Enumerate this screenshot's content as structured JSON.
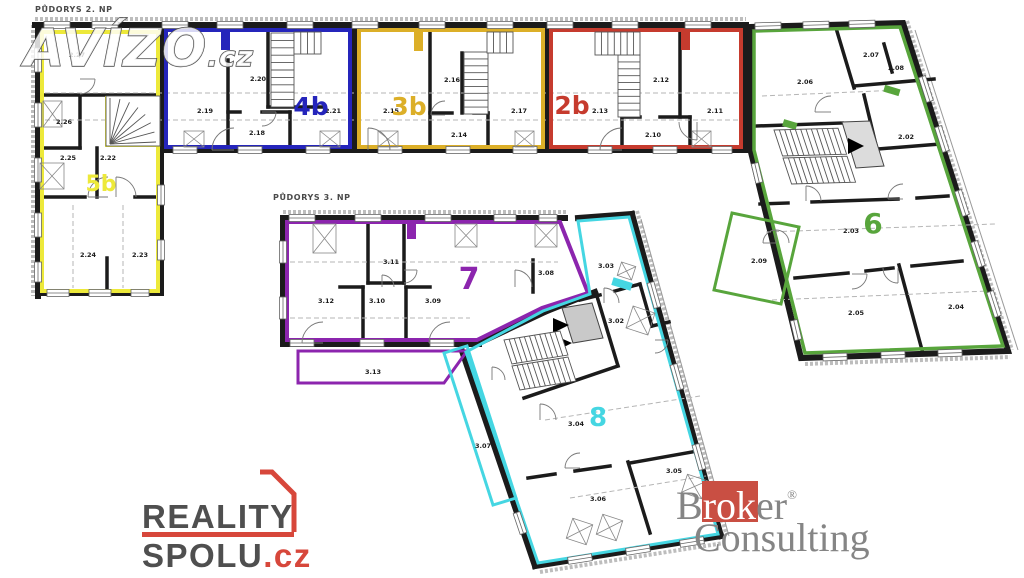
{
  "watermark": {
    "name": "AVÍZO",
    "tld": ".cz"
  },
  "plans": [
    {
      "title": "PŮDORYS 2. NP"
    },
    {
      "title": "PŮDORYS 3. NP"
    }
  ],
  "units": [
    {
      "id": "5b",
      "label": "5b",
      "color": "#ede93a",
      "x": 101,
      "y": 191,
      "size": 22
    },
    {
      "id": "4b",
      "label": "4b",
      "color": "#2525bb",
      "x": 311,
      "y": 115,
      "size": 25
    },
    {
      "id": "3b",
      "label": "3b",
      "color": "#dcaf28",
      "x": 409,
      "y": 115,
      "size": 25
    },
    {
      "id": "2b",
      "label": "2b",
      "color": "#c63b2e",
      "x": 572,
      "y": 114,
      "size": 25
    },
    {
      "id": "6",
      "label": "6",
      "color": "#58a53c",
      "x": 873,
      "y": 233,
      "size": 28
    },
    {
      "id": "7",
      "label": "7",
      "color": "#8c25ae",
      "x": 469,
      "y": 289,
      "size": 30
    },
    {
      "id": "8",
      "label": "8",
      "color": "#45d6e2",
      "x": 598,
      "y": 426,
      "size": 26
    }
  ],
  "rooms2": [
    {
      "n": "2.27",
      "x": 77,
      "y": 57
    },
    {
      "n": "2.26",
      "x": 64,
      "y": 124
    },
    {
      "n": "2.25",
      "x": 68,
      "y": 160
    },
    {
      "n": "2.22",
      "x": 108,
      "y": 160
    },
    {
      "n": "2.24",
      "x": 88,
      "y": 257
    },
    {
      "n": "2.23",
      "x": 140,
      "y": 257
    },
    {
      "n": "2.19",
      "x": 205,
      "y": 113
    },
    {
      "n": "2.20",
      "x": 258,
      "y": 81
    },
    {
      "n": "2.18",
      "x": 257,
      "y": 135
    },
    {
      "n": "2.21",
      "x": 333,
      "y": 113
    },
    {
      "n": "2.15",
      "x": 391,
      "y": 113
    },
    {
      "n": "2.16",
      "x": 452,
      "y": 82
    },
    {
      "n": "2.14",
      "x": 459,
      "y": 137
    },
    {
      "n": "2.17",
      "x": 519,
      "y": 113
    },
    {
      "n": "2.13",
      "x": 600,
      "y": 113
    },
    {
      "n": "2.12",
      "x": 661,
      "y": 82
    },
    {
      "n": "2.10",
      "x": 653,
      "y": 137
    },
    {
      "n": "2.11",
      "x": 715,
      "y": 113
    },
    {
      "n": "2.06",
      "x": 805,
      "y": 84
    },
    {
      "n": "2.07",
      "x": 871,
      "y": 57
    },
    {
      "n": "2.08",
      "x": 896,
      "y": 70
    },
    {
      "n": "2.02",
      "x": 906,
      "y": 139
    },
    {
      "n": "2.03",
      "x": 851,
      "y": 233
    },
    {
      "n": "2.05",
      "x": 856,
      "y": 315
    },
    {
      "n": "2.04",
      "x": 956,
      "y": 309
    },
    {
      "n": "2.09",
      "x": 759,
      "y": 263
    }
  ],
  "rooms3": [
    {
      "n": "3.11",
      "x": 391,
      "y": 264
    },
    {
      "n": "3.12",
      "x": 326,
      "y": 303
    },
    {
      "n": "3.10",
      "x": 377,
      "y": 303
    },
    {
      "n": "3.09",
      "x": 433,
      "y": 303
    },
    {
      "n": "3.08",
      "x": 546,
      "y": 275
    },
    {
      "n": "3.13",
      "x": 373,
      "y": 374
    },
    {
      "n": "3.03",
      "x": 606,
      "y": 268
    },
    {
      "n": "3.02",
      "x": 616,
      "y": 323
    },
    {
      "n": "3.07",
      "x": 483,
      "y": 448
    },
    {
      "n": "3.04",
      "x": 576,
      "y": 426
    },
    {
      "n": "3.05",
      "x": 674,
      "y": 473
    },
    {
      "n": "3.06",
      "x": 598,
      "y": 501
    }
  ],
  "logos": {
    "reality": {
      "line1": "REALITY",
      "line2": "SPOLU",
      "tld": ".cz",
      "red": "#d7473b",
      "gray": "#4f4f4f"
    },
    "broker": {
      "b": "B",
      "rok": "rok",
      "er": "er",
      "reg": "®",
      "line2": "Consulting",
      "red": "#c94f43"
    }
  }
}
